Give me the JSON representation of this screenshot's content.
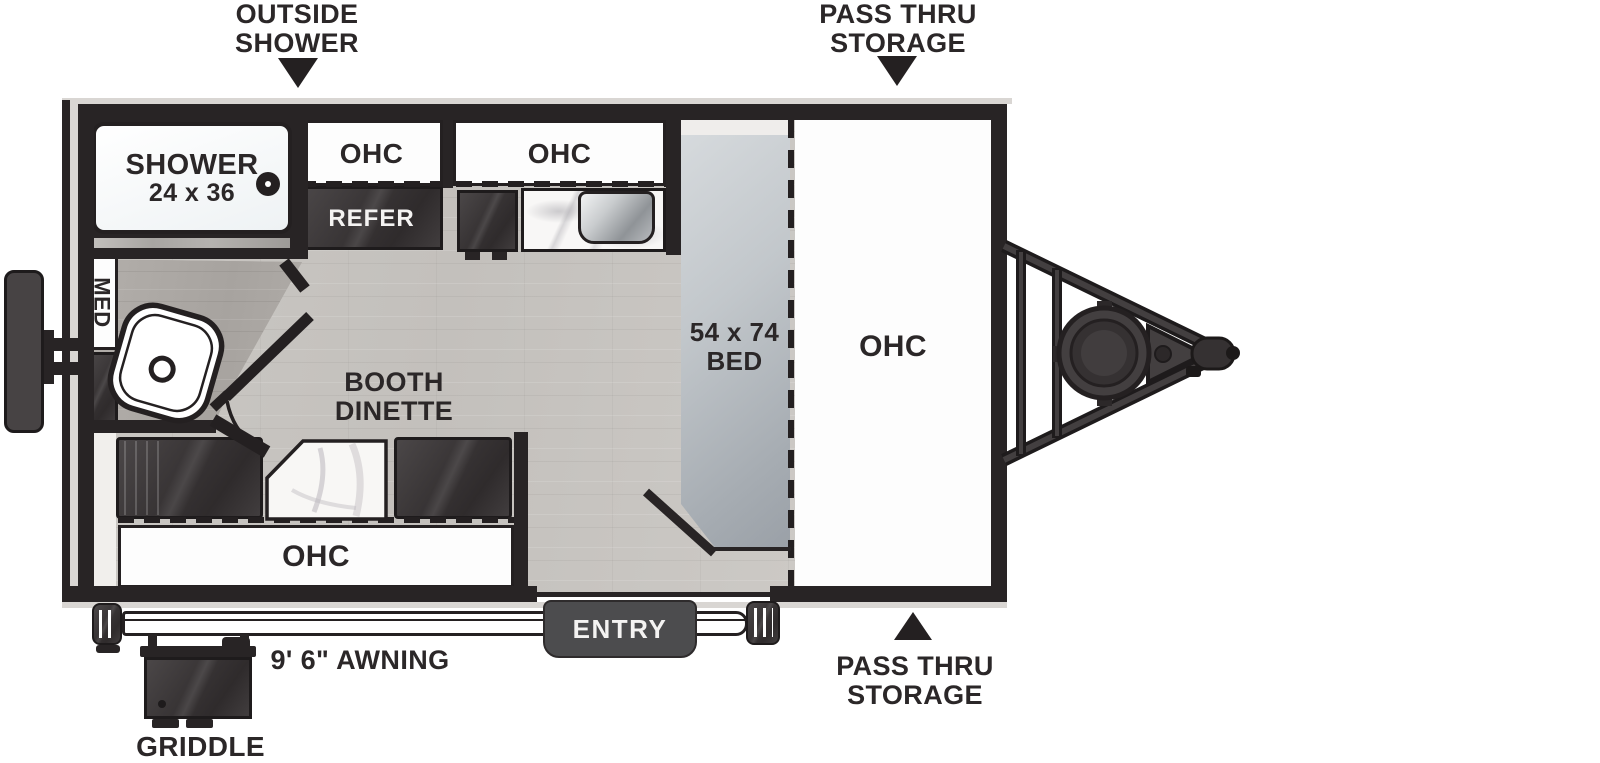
{
  "diagram": {
    "type": "travel-trailer floor plan",
    "colors": {
      "wall": "#282425",
      "furniture_dark": "#3a3637",
      "floor_main": "#c8c5c1",
      "floor_bath": "#aeaaa6",
      "bed_gray": "#b4bac0",
      "entry_step": "#4c4c4e",
      "body_edge": "#d9d6d3"
    },
    "callouts": {
      "outside_shower": {
        "line1": "OUTSIDE",
        "line2": "SHOWER"
      },
      "pass_thru": {
        "line1": "PASS THRU",
        "line2": "STORAGE"
      }
    },
    "labels": {
      "shower": "SHOWER",
      "shower_size": "24 x 36",
      "ohc": "OHC",
      "refer": "REFER",
      "med": "MED",
      "dinette_line1": "BOOTH",
      "dinette_line2": "DINETTE",
      "bed_size": "54 x 74",
      "bed": "BED",
      "entry": "ENTRY",
      "awning": "9' 6\" AWNING",
      "griddle": "GRIDDLE"
    }
  }
}
